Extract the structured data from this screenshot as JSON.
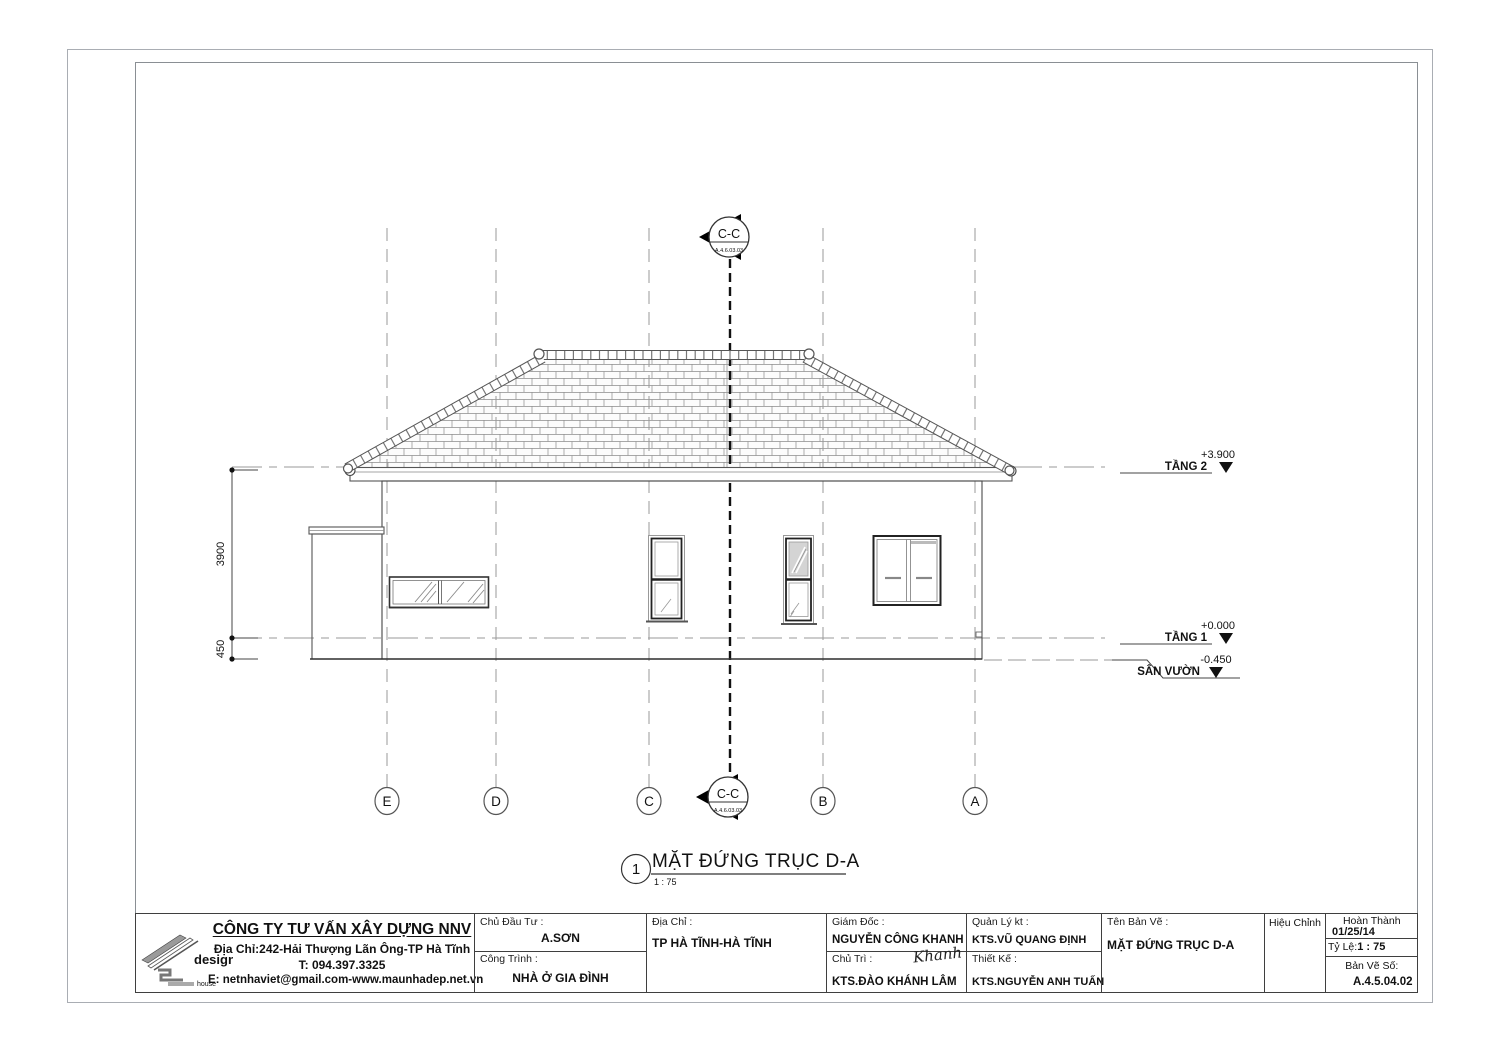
{
  "company": {
    "name": "CÔNG TY TƯ VẤN XÂY DỰNG NNV",
    "address": "Địa Chỉ:242-Hải Thượng Lãn Ông-TP Hà Tĩnh",
    "phone": "T: 094.397.3325",
    "email": "E: netnhaviet@gmail.com-www.maunhadep.net.vn",
    "logo_text": "design",
    "logo_subtext": "house"
  },
  "title_block": {
    "investor_label": "Chủ Đầu Tư :",
    "investor": "A.SƠN",
    "project_label": "Công Trình :",
    "project": "NHÀ Ở GIA ĐÌNH",
    "address_label": "Địa Chỉ :",
    "address": "TP HÀ TĨNH-HÀ TĨNH",
    "director_label": "Giám Đốc :",
    "director": "NGUYỄN CÔNG KHANH",
    "lead_label": "Chủ Trì :",
    "lead_signature": "Khanh",
    "lead": "KTS.ĐÀO KHÁNH LÂM",
    "manager_label": "Quản Lý kt :",
    "manager": "KTS.VŨ QUANG ĐỊNH",
    "designer_label": "Thiết Kế :",
    "designer": "KTS.NGUYỄN ANH TUẤN",
    "drawing_name_label": "Tên Bản Vẽ :",
    "drawing_name": "MẶT ĐỨNG TRỤC D-A",
    "revision_label": "Hiệu Chỉnh",
    "completed_label": "Hoàn Thành",
    "completed_date": "01/25/14",
    "scale_label": "Tỷ Lệ:",
    "scale": "1 : 75",
    "sheet_no_label": "Bản Vẽ Số:",
    "sheet_no": "A.4.5.04.02"
  },
  "drawing": {
    "view_number": "1",
    "view_title": "MẶT ĐỨNG TRỤC D-A",
    "view_scale": "1 : 75",
    "grid_labels": [
      "E",
      "D",
      "C",
      "B",
      "A"
    ],
    "section_label": "C-C",
    "section_ref": "A.4.6.03.03",
    "levels": [
      {
        "name": "TẦNG 2",
        "value": "+3.900"
      },
      {
        "name": "TẦNG 1",
        "value": "+0.000"
      },
      {
        "name": "SÂN VƯỜN",
        "value": "-0.450"
      }
    ],
    "dimensions": [
      "3900",
      "450"
    ]
  }
}
